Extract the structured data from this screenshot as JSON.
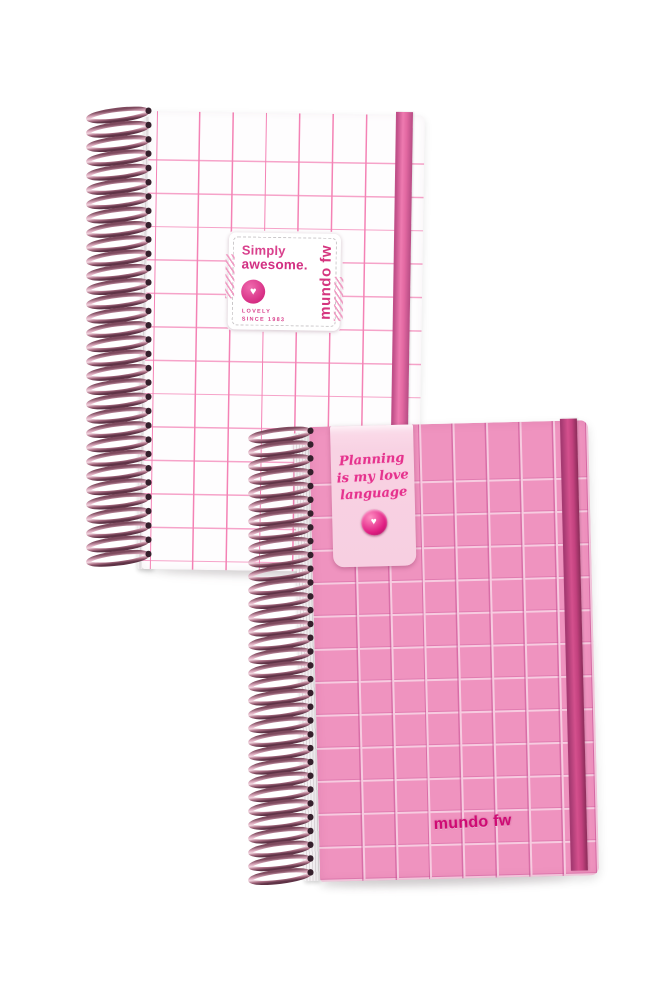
{
  "scene": {
    "description": "Product photo of two wire-bound grid notebooks, one white with pink grid and one pink with white grid",
    "background_color": "#ffffff"
  },
  "white_notebook": {
    "name": "white grid notebook",
    "spiral_loops": 32,
    "colors": {
      "cover": "#fefdfe",
      "grid_line": "#f482b5",
      "elastic_band": "#e268a1",
      "spiral_wire": "#b9839a"
    },
    "label": {
      "title_line1": "Simply",
      "title_line2": "awesome.",
      "heart_icon": "♥",
      "footer_line1": "LOVELY",
      "footer_line2": "SINCE 1983",
      "brand_vertical": "mundo fw"
    }
  },
  "pink_notebook": {
    "name": "pink grid notebook",
    "spiral_loops": 33,
    "colors": {
      "cover": "#ef93bf",
      "grid_line": "#f7cbe0",
      "elastic_band": "#c2417e",
      "tag": "#f8d2e3"
    },
    "tag": {
      "script_line1": "Planning",
      "script_line2": "is my love",
      "script_line3": "language",
      "heart_icon": "♥"
    },
    "brand": "mundo fw"
  }
}
